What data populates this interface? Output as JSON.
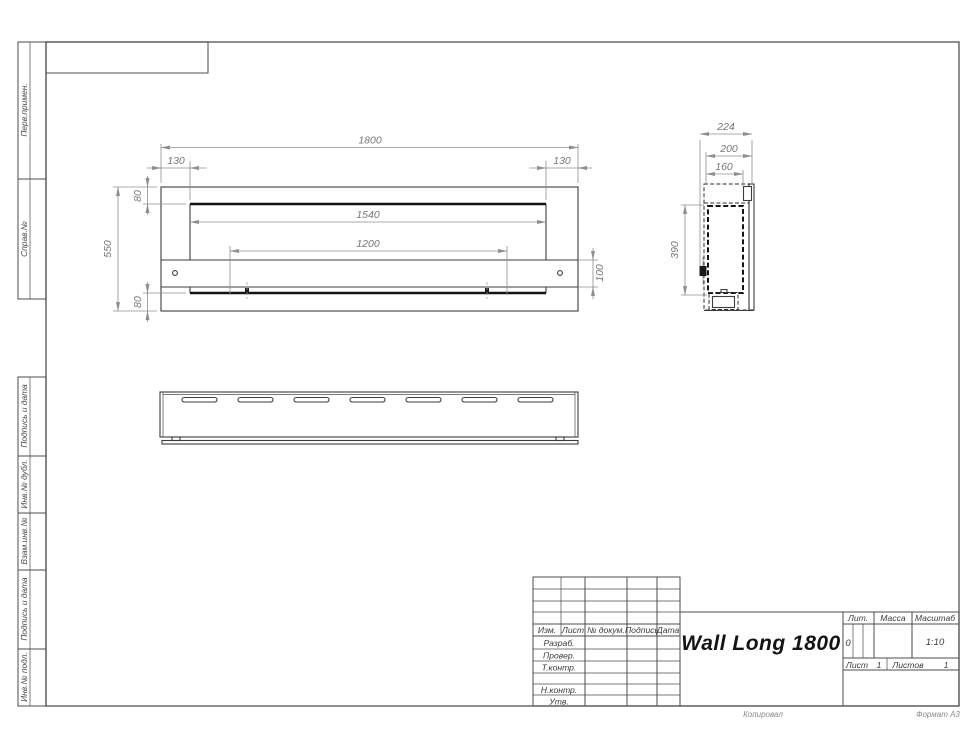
{
  "sheet": {
    "footer_copied": "Копировал",
    "footer_format": "Формат А3"
  },
  "margin_labels": [
    "Перв.примен.",
    "Справ.№",
    "Подпись и дата",
    "Инв.№ дубл.",
    "Взам.инв.№",
    "Подпись и дата",
    "Инв.№ подл."
  ],
  "title_block": {
    "title": "Wall Long 1800",
    "col_izm": "Изм.",
    "col_list": "Лист",
    "col_doc": "№ докум.",
    "col_sign": "Подпись",
    "col_date": "Дата",
    "row_razrab": "Разраб.",
    "row_prover": "Провер.",
    "row_tkontr": "Т.контр.",
    "row_nkontr": "Н.контр.",
    "row_utv": "Утв.",
    "lit_label": "Лит.",
    "mass_label": "Масса",
    "scale_label": "Масштаб",
    "lit_value": "0",
    "scale_value": "1:10",
    "sheet_label": "Лист",
    "sheet_value": "1",
    "sheets_label": "Листов",
    "sheets_value": "1"
  },
  "dims": {
    "overall_width": "1800",
    "offset_left": "130",
    "offset_right": "130",
    "flange_top": "80",
    "opening_width": "1540",
    "overall_height": "550",
    "mount_span": "1200",
    "bracket_height": "100",
    "flange_bottom": "80",
    "depth_overall": "224",
    "depth_body": "200",
    "depth_inner": "160",
    "bracket_drop": "390"
  }
}
